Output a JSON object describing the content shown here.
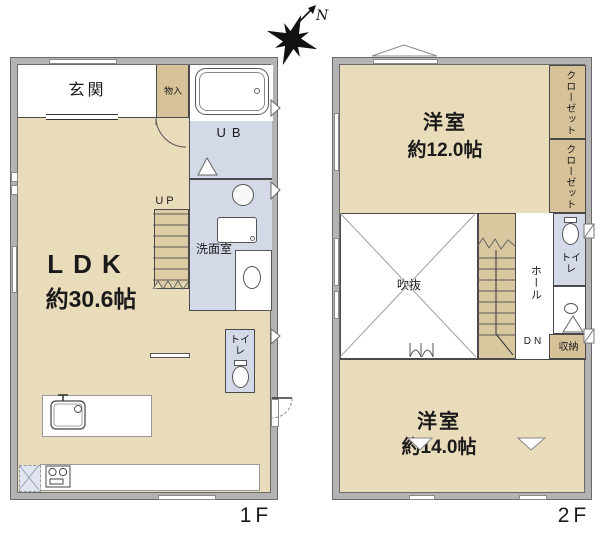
{
  "compass": {
    "north_label": "N"
  },
  "palette": {
    "wall_gray": "#b3b3b3",
    "floor_tan": "#e9dcba",
    "closet_tan": "#d7c199",
    "wet_area_blue": "#d3d9e6",
    "line": "#4a4a4a"
  },
  "floor1": {
    "floor_label": "1F",
    "entrance_label": "玄関",
    "storage_label": "物入",
    "bath_label": "UB",
    "stairs_up_label": "UP",
    "washroom_label": "洗面室",
    "ldk_label": "LDK",
    "ldk_size": "約30.6帖",
    "toilet_label": "トイレ"
  },
  "floor2": {
    "floor_label": "2F",
    "bedroom_top_label": "洋室",
    "bedroom_top_size": "約12.0帖",
    "closet_top_label": "クローゼット",
    "closet_bottom_label": "クローゼット",
    "void_label": "吹抜",
    "hall_label": "ホール",
    "toilet_label": "トイレ",
    "stairs_down_label": "DN",
    "storage_label": "収納",
    "bedroom_bottom_label": "洋室",
    "bedroom_bottom_size": "約14.0帖"
  }
}
